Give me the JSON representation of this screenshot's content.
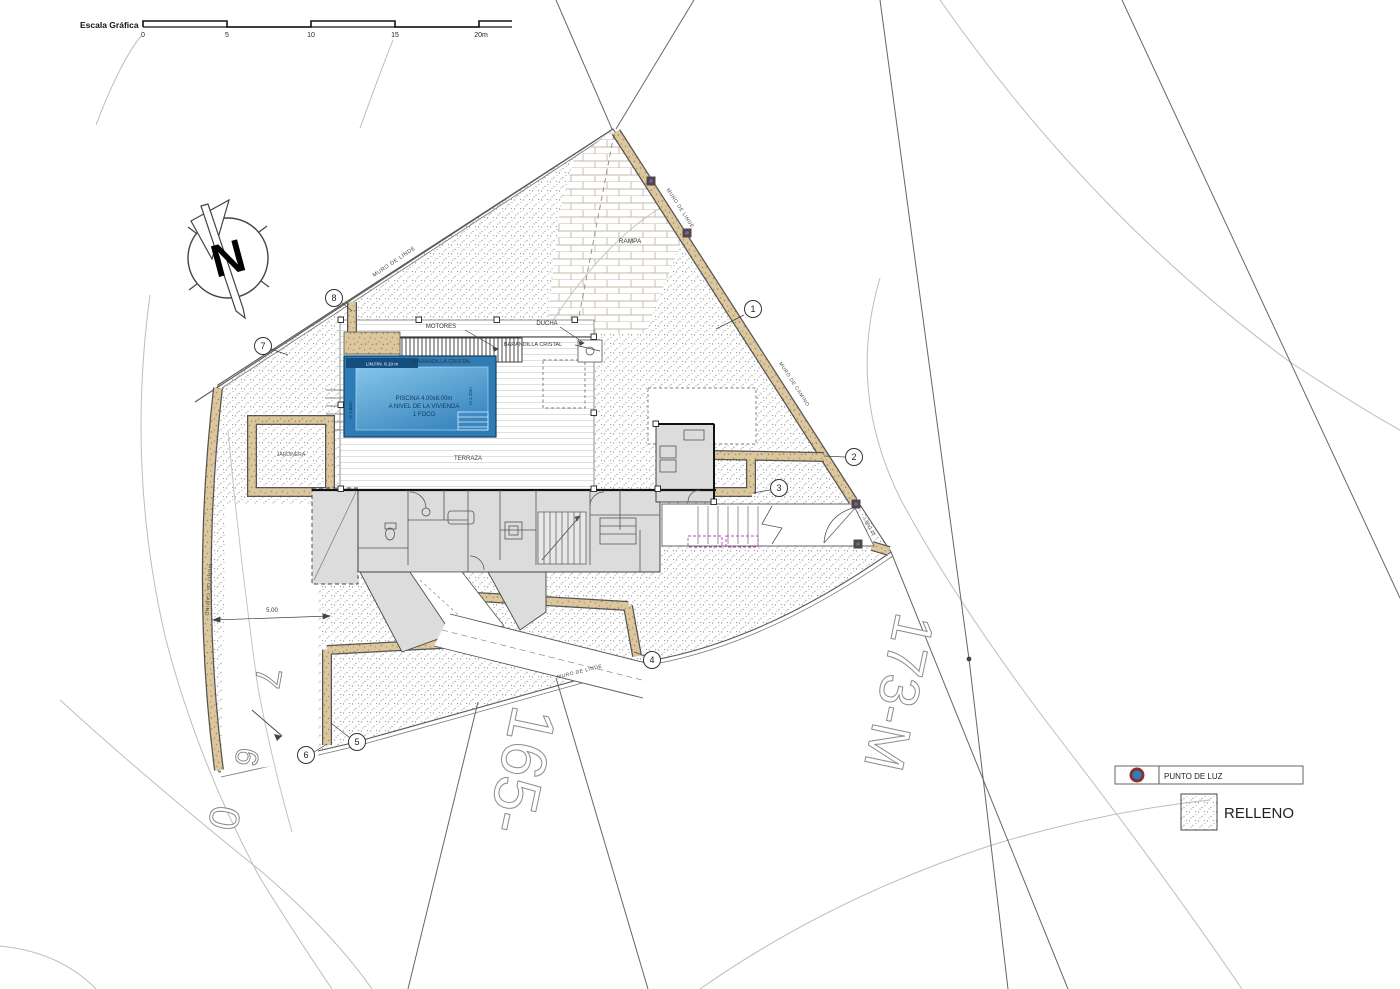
{
  "scale_bar": {
    "label": "Escala Gráfica",
    "ticks": [
      "0",
      "5",
      "10",
      "15",
      "20m"
    ]
  },
  "compass": {
    "label": "N"
  },
  "plan": {
    "labels": {
      "rampa": "RAMPA",
      "motores": "MOTORES",
      "ducha": "DUCHA",
      "barandilla_top": "BARANDILLA CRISTAL",
      "barandilla_pool": "BARANDILLA CRISTAL",
      "terraza": "TERRAZA",
      "jardinera": "JARDINERA",
      "piscina_1": "PISCINA 4.00x8.00m",
      "piscina_2": "A NIVEL DE LA VIVIENDA",
      "piscina_3": "1 FOCO",
      "pool_edge": "LIN.FIN. 8.10 m",
      "pool_depth_left": "H 1.80m",
      "pool_depth_right": "H 1.20m",
      "muro_linde_nw": "MURO DE LINDE",
      "muro_linde_ne": "MURO DE LINDE",
      "muro_linde_s": "MURO DE LINDE",
      "muro_camino_e": "MURO DE CAMINO",
      "muro_camino_w": "MURO DE CAMINO",
      "wall_offset_dim": "5.00",
      "gate_dim": "1.80x1.20"
    },
    "markers": [
      "1",
      "2",
      "3",
      "4",
      "5",
      "6",
      "7",
      "8"
    ],
    "parcels": {
      "south": "165-",
      "east": "173-M"
    },
    "road_glyphs": [
      "7",
      "6",
      "0"
    ]
  },
  "legend": {
    "light_label": "PUNTO DE LUZ",
    "fill_label": "RELLENO"
  },
  "colors": {
    "pool_border": "#2e7cb5",
    "pool_water_light": "#7fc2e8",
    "pool_water_dark": "#3a86bf",
    "pool_header": "#134e7e",
    "wall_tan": "#dcc79e",
    "house_gray": "#dcdcdc",
    "magenta": "#bb44bb",
    "light_point_blue": "#2d7fc1",
    "light_point_ring": "#8a3030"
  }
}
